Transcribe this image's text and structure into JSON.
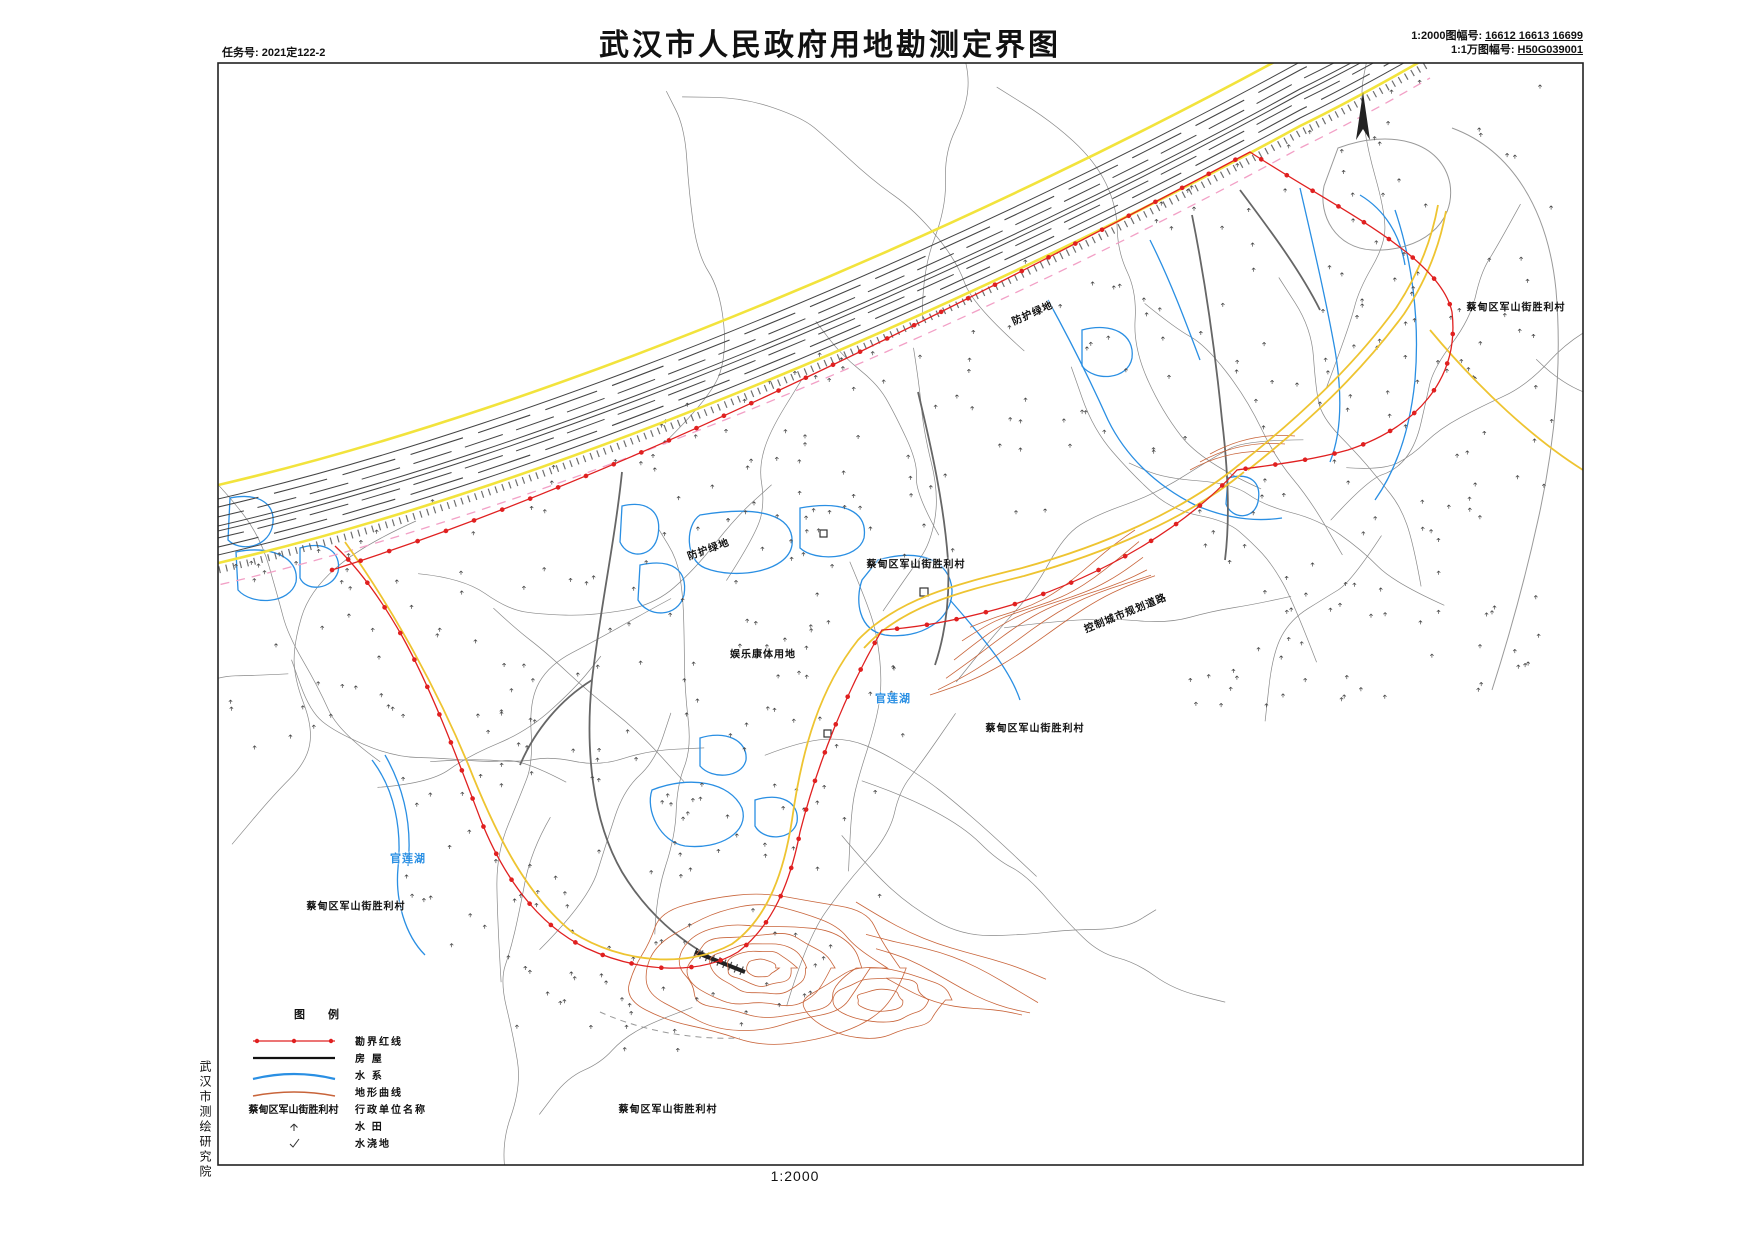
{
  "header": {
    "task_no": "任务号: 2021定122-2",
    "title": "武汉市人民政府用地勘测定界图",
    "sheet_2000_label": "1:2000图幅号:",
    "sheet_2000_value": "16612 16613 16699",
    "sheet_10000_label": "1:1万图幅号:",
    "sheet_10000_value": "H50G039001"
  },
  "footer": {
    "scale": "1:2000"
  },
  "side": {
    "institute": "武汉市测绘研究院"
  },
  "legend": {
    "title": "图  例",
    "items": [
      {
        "symbol": "red-boundary-line",
        "label": "勘界红线"
      },
      {
        "symbol": "black-line",
        "label": "房  屋"
      },
      {
        "symbol": "blue-curve",
        "label": "水  系"
      },
      {
        "symbol": "orange-curve",
        "label": "地形曲线"
      },
      {
        "symbol": "admin-name-sample",
        "sample": "蔡甸区军山街胜利村",
        "label": "行政单位名称"
      },
      {
        "symbol": "paddy-symbol",
        "label": "水  田"
      },
      {
        "symbol": "irrigated-symbol",
        "label": "水浇地"
      }
    ]
  },
  "map_labels": [
    {
      "id": "green-belt-1",
      "text": "防护绿地",
      "x": 708,
      "y": 548,
      "rot": -20,
      "color": "#111111",
      "size": 10
    },
    {
      "id": "green-belt-2",
      "text": "防护绿地",
      "x": 1032,
      "y": 312,
      "rot": -24,
      "color": "#111111",
      "size": 10
    },
    {
      "id": "village-1",
      "text": "蔡甸区军山街胜利村",
      "x": 916,
      "y": 563,
      "rot": 0,
      "color": "#111111",
      "size": 10
    },
    {
      "id": "planning-road",
      "text": "控制城市规划道路",
      "x": 1125,
      "y": 612,
      "rot": -22,
      "color": "#111111",
      "size": 10
    },
    {
      "id": "recreation",
      "text": "娱乐康体用地",
      "x": 763,
      "y": 653,
      "rot": 0,
      "color": "#111111",
      "size": 10
    },
    {
      "id": "lake-1",
      "text": "官莲湖",
      "x": 893,
      "y": 698,
      "rot": 0,
      "color": "#2a8fe3",
      "size": 11
    },
    {
      "id": "village-2",
      "text": "蔡甸区军山街胜利村",
      "x": 1035,
      "y": 727,
      "rot": 0,
      "color": "#111111",
      "size": 10
    },
    {
      "id": "village-3",
      "text": "蔡甸区军山街胜利村",
      "x": 1516,
      "y": 306,
      "rot": 0,
      "color": "#111111",
      "size": 10
    },
    {
      "id": "village-4",
      "text": "蔡甸区军山街胜利村",
      "x": 356,
      "y": 905,
      "rot": 0,
      "color": "#111111",
      "size": 10
    },
    {
      "id": "lake-2",
      "text": "官莲湖",
      "x": 408,
      "y": 858,
      "rot": 0,
      "color": "#2a8fe3",
      "size": 11
    },
    {
      "id": "village-5",
      "text": "蔡甸区军山街胜利村",
      "x": 668,
      "y": 1108,
      "rot": 0,
      "color": "#111111",
      "size": 10
    }
  ],
  "colors": {
    "boundary_red": "#e02020",
    "road_yellow": "#f2e33c",
    "planning_yellow": "#eec431",
    "water_blue": "#2a8fe3",
    "contour_orange": "#c8643a",
    "pink_dash": "#f2a0c6",
    "frame": "#222222"
  }
}
